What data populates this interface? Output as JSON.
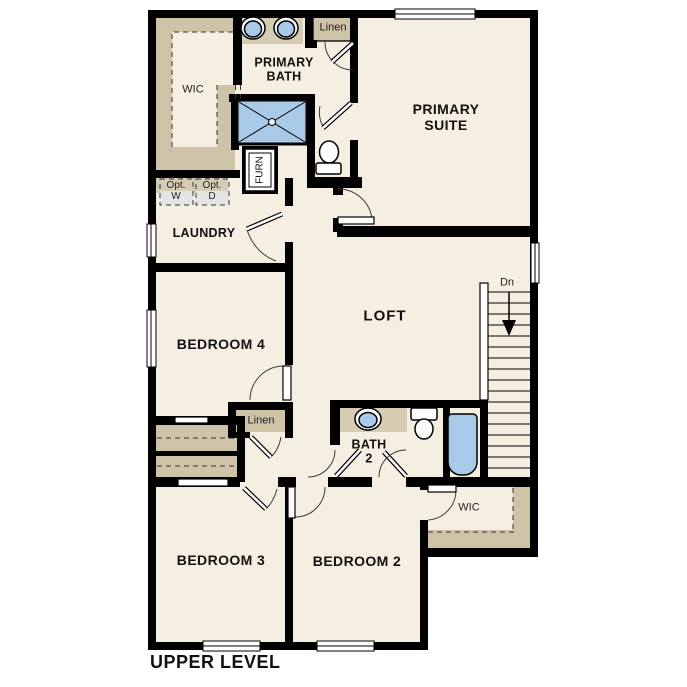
{
  "plan": {
    "title": "UPPER LEVEL",
    "rooms": {
      "wic1": "WIC",
      "primary_bath": "PRIMARY\nBATH",
      "linen1": "Linen",
      "primary_suite": "PRIMARY\nSUITE",
      "opt_w": "Opt.\nW",
      "opt_d": "Opt.\nD",
      "laundry": "LAUNDRY",
      "furn": "FURN",
      "loft": "LOFT",
      "stairs_dn": "Dn",
      "bedroom4": "BEDROOM 4",
      "linen2": "Linen",
      "bath2": "BATH\n2",
      "wic2": "WIC",
      "bedroom3": "BEDROOM 3",
      "bedroom2": "BEDROOM 2"
    },
    "colors": {
      "wall": "#000000",
      "room_fill": "#f5efe2",
      "closet_tan": "#cec3a7",
      "counter_tan": "#d6cbb3",
      "fixture_blue": "#a9c9e8",
      "appliance_gray": "#e4e4e4"
    }
  }
}
